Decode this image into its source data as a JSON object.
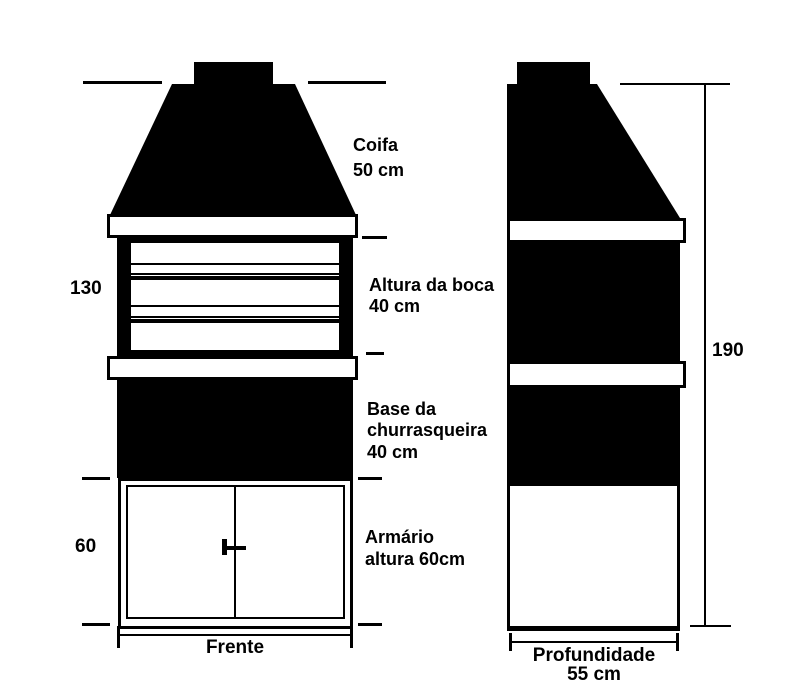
{
  "drawing": {
    "subject": "churrasqueira (barbecue) technical drawing, front and depth elevations",
    "colors": {
      "ink": "#000000",
      "background": "#ffffff"
    }
  },
  "dimensions": {
    "front_upper": "130",
    "front_lower": "60",
    "side_total": "190",
    "front_width_label": "Frente",
    "depth_label": "Profundidade",
    "depth_value": "55 cm"
  },
  "annotations": {
    "coifa": [
      "Coifa",
      "50 cm"
    ],
    "boca": [
      "Altura da boca",
      "40 cm"
    ],
    "base": [
      "Base da",
      "churrasqueira",
      "40 cm"
    ],
    "armario": [
      "Armário",
      "altura 60cm"
    ]
  }
}
